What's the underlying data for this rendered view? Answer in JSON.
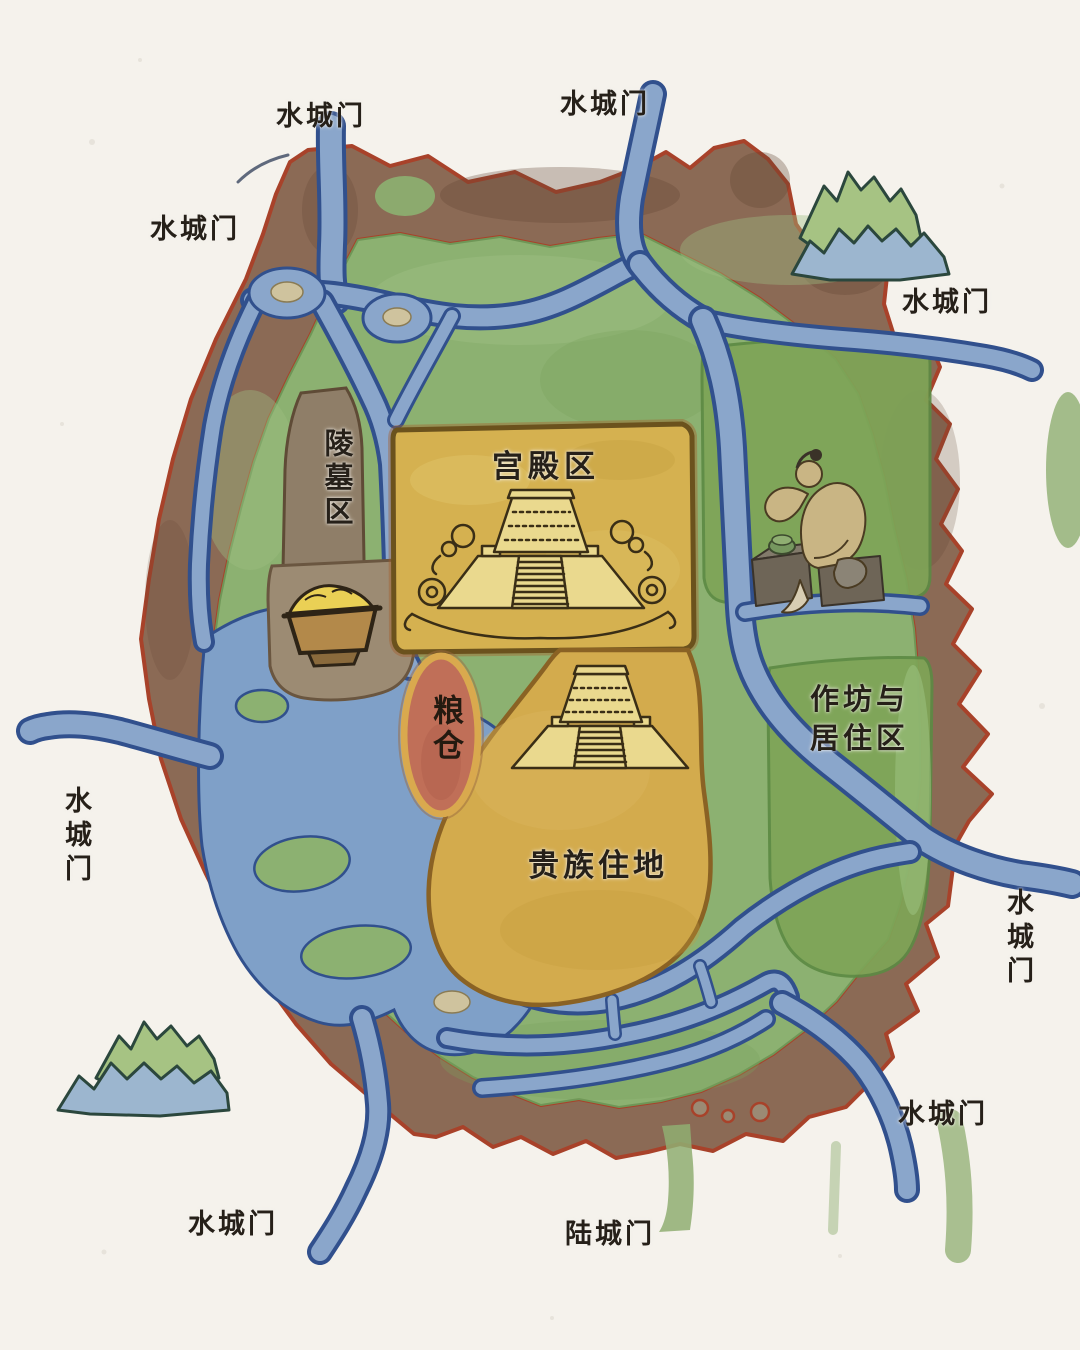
{
  "map": {
    "subject": "hand-painted watercolor map of an ancient walled city with waterways",
    "regions": {
      "palace": {
        "label": "宫殿区"
      },
      "cemetery": {
        "label": "陵墓区"
      },
      "granary": {
        "label": "粮仓"
      },
      "noble": {
        "label": "贵族住地"
      },
      "workshop": {
        "label_line1": "作坊与",
        "label_line2": "居住区"
      }
    },
    "gates": {
      "list": [
        {
          "id": "water-gate-north-west",
          "label": "水城门"
        },
        {
          "id": "water-gate-north",
          "label": "水城门"
        },
        {
          "id": "water-gate-west-upper",
          "label": "水城门"
        },
        {
          "id": "water-gate-north-east",
          "label": "水城门"
        },
        {
          "id": "water-gate-west",
          "label": "水城门"
        },
        {
          "id": "water-gate-east",
          "label": "水城门"
        },
        {
          "id": "water-gate-south-east",
          "label": "水城门"
        },
        {
          "id": "water-gate-south-west",
          "label": "水城门"
        },
        {
          "id": "land-gate-south",
          "label": "陆城门"
        }
      ]
    },
    "icons": {
      "palace_platform": "stepped-earthen-platform-with-clouds-icon",
      "noble_platform": "stepped-earthen-platform-icon",
      "craftsman": "seated-jade-craftsman-icon",
      "grain_basket": "grain-trough-icon",
      "mountains_top_right": "mountain-ridge-icon",
      "mountains_bottom_left": "mountain-ridge-icon"
    },
    "colors": {
      "paper": "#f5f2ec",
      "wall_fill": "#8b6a55",
      "wall_outline": "#a8422a",
      "field_green": "#8cb171",
      "workshop_green": "#7ea557",
      "water_blue": "#8aa6cb",
      "water_outline": "#31508d",
      "palace_yellow": "#d5b150",
      "noble_yellow": "#d3ab4d",
      "cemetery_taupe": "#8f7e68",
      "granary_red": "#c06f58",
      "granary_ring": "#d9a94e",
      "mountain_green": "#a6c383",
      "mountain_blue": "#9cb6cf",
      "label_ink": "#262019"
    }
  }
}
